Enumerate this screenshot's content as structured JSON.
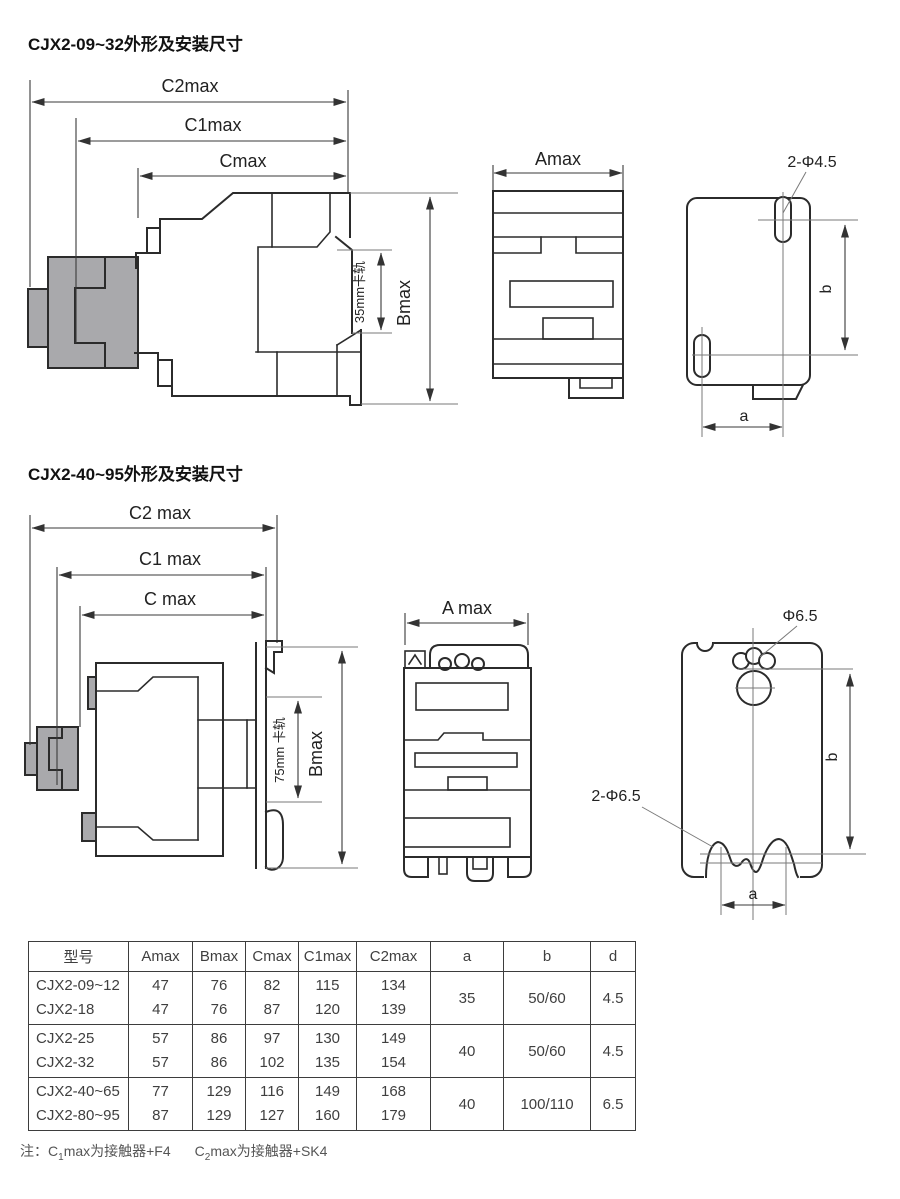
{
  "section1": {
    "title": "CJX2-09~32外形及安装尺寸",
    "labels": {
      "c2": "C2max",
      "c1": "C1max",
      "c": "Cmax",
      "a_dim": "Amax",
      "b_dim": "Bmax",
      "rail": "35mm卡轨",
      "holes": "2-Φ4.5",
      "a_small": "a",
      "b_small": "b"
    }
  },
  "section2": {
    "title": "CJX2-40~95外形及安装尺寸",
    "labels": {
      "c2": "C2 max",
      "c1": "C1 max",
      "c": "C max",
      "a_dim": "A max",
      "b_dim": "Bmax",
      "rail": "75mm 卡轨",
      "hole_top": "Φ6.5",
      "holes_bottom": "2-Φ6.5",
      "a_small": "a",
      "b_small": "b"
    }
  },
  "table": {
    "headers": [
      "型号",
      "Amax",
      "Bmax",
      "Cmax",
      "C1max",
      "C2max",
      "a",
      "b",
      "d"
    ],
    "groups": [
      {
        "models": [
          "CJX2-09~12",
          "CJX2-18"
        ],
        "amax": [
          "47",
          "47"
        ],
        "bmax": [
          "76",
          "76"
        ],
        "cmax": [
          "82",
          "87"
        ],
        "c1max": [
          "115",
          "120"
        ],
        "c2max": [
          "134",
          "139"
        ],
        "a": "35",
        "b": "50/60",
        "d": "4.5"
      },
      {
        "models": [
          "CJX2-25",
          "CJX2-32"
        ],
        "amax": [
          "57",
          "57"
        ],
        "bmax": [
          "86",
          "86"
        ],
        "cmax": [
          "97",
          "102"
        ],
        "c1max": [
          "130",
          "135"
        ],
        "c2max": [
          "149",
          "154"
        ],
        "a": "40",
        "b": "50/60",
        "d": "4.5"
      },
      {
        "models": [
          "CJX2-40~65",
          "CJX2-80~95"
        ],
        "amax": [
          "77",
          "87"
        ],
        "bmax": [
          "129",
          "129"
        ],
        "cmax": [
          "116",
          "127"
        ],
        "c1max": [
          "149",
          "160"
        ],
        "c2max": [
          "168",
          "179"
        ],
        "a": "40",
        "b": "100/110",
        "d": "6.5"
      }
    ]
  },
  "note": {
    "p1": "注：C",
    "s1": "1",
    "p2": "max为接触器+F4",
    "p3": "C",
    "s2": "2",
    "p4": "max为接触器+SK4"
  },
  "colors": {
    "line": "#2b2b2b",
    "gray_fill": "#a9a9ac",
    "accent": "#3d3d3d"
  }
}
